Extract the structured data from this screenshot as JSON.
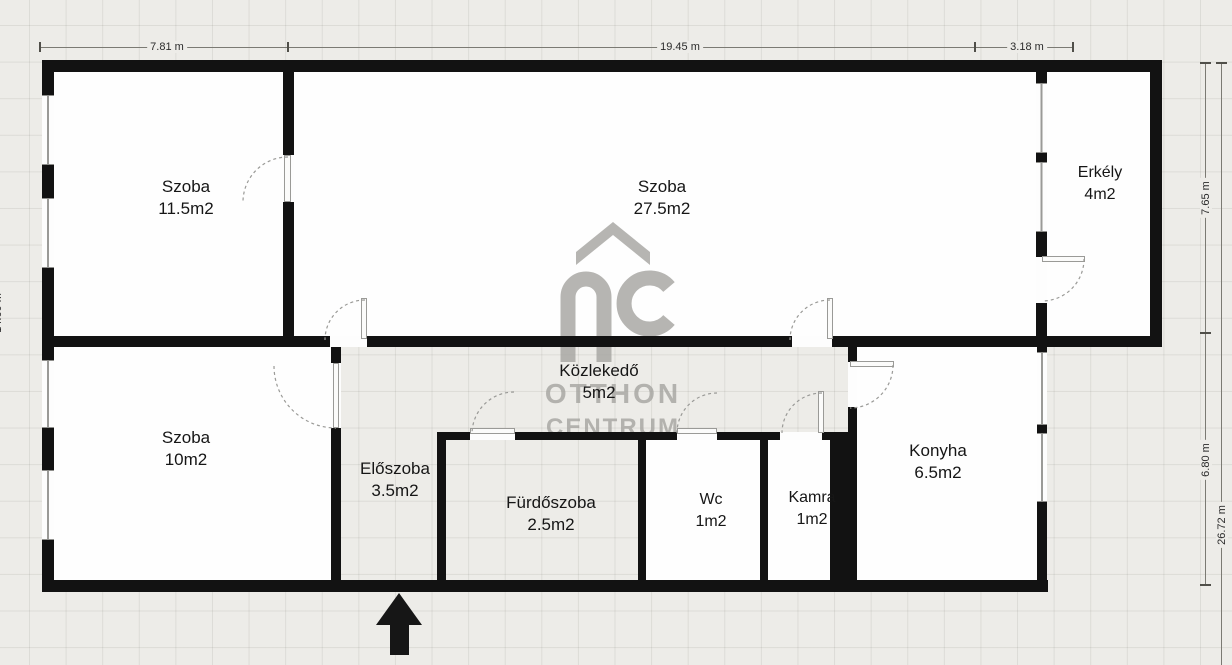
{
  "plan": {
    "rooms": [
      {
        "id": "szoba-1",
        "name": "Szoba",
        "area": "11.5m2"
      },
      {
        "id": "szoba-2",
        "name": "Szoba",
        "area": "27.5m2"
      },
      {
        "id": "erkely",
        "name": "Erkély",
        "area": "4m2"
      },
      {
        "id": "kozlekedo",
        "name": "Közlekedő",
        "area": "5m2"
      },
      {
        "id": "szoba-3",
        "name": "Szoba",
        "area": "10m2"
      },
      {
        "id": "eloszoba",
        "name": "Előszoba",
        "area": "3.5m2"
      },
      {
        "id": "furdoszoba",
        "name": "Fürdőszoba",
        "area": "2.5m2"
      },
      {
        "id": "wc",
        "name": "Wc",
        "area": "1m2"
      },
      {
        "id": "kamra",
        "name": "Kamra",
        "area": "1m2"
      },
      {
        "id": "konyha",
        "name": "Konyha",
        "area": "6.5m2"
      }
    ],
    "dimensions": {
      "top": [
        "7.81 m",
        "19.45 m",
        "3.18 m"
      ],
      "right": [
        "7.65 m",
        "6.80 m",
        "26.72 m"
      ],
      "left": [
        "14.60 m"
      ]
    },
    "watermark": {
      "monogram": "OC",
      "line1": "OTTHON",
      "line2": "CENTRUM"
    },
    "colors": {
      "wall": "#121212",
      "watermark": "#a5a4a0",
      "background": "#edece8"
    }
  }
}
